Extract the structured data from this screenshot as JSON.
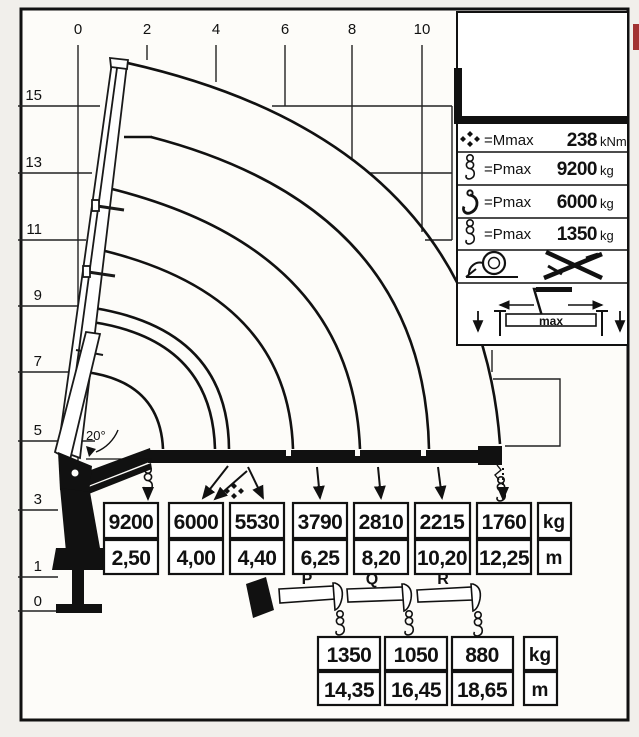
{
  "chart_data": {
    "type": "line",
    "title": "Crane load capacity diagram",
    "x_ticks": [
      0,
      2,
      4,
      6,
      8,
      10
    ],
    "y_ticks": [
      15,
      13,
      11,
      9,
      7,
      5,
      3,
      1,
      0
    ],
    "boom_angle_deg": 20,
    "series": [
      {
        "name": "hydraulic-extensions",
        "loads_kg": [
          9200,
          6000,
          5530,
          3790,
          2810,
          2215,
          1760
        ],
        "outreach_m": [
          2.5,
          4.0,
          4.4,
          6.25,
          8.2,
          10.2,
          12.25
        ]
      },
      {
        "name": "manual-extensions",
        "labels": [
          "P",
          "Q",
          "R"
        ],
        "loads_kg": [
          1350,
          1050,
          880
        ],
        "outreach_m": [
          14.35,
          16.45,
          18.65
        ]
      }
    ],
    "maxima": {
      "Mmax_kNm": 238,
      "Pmax_main_kg": 9200,
      "Pmax_hook_kg": 6000,
      "Pmax_ext_kg": 1350
    },
    "legend_position": "top-right",
    "grid": true
  },
  "axes": {
    "x_ticks": [
      "0",
      "2",
      "4",
      "6",
      "8",
      "10"
    ],
    "y_ticks": [
      "15",
      "13",
      "11",
      "9",
      "7",
      "5",
      "3",
      "1",
      "0"
    ]
  },
  "annotations": {
    "boom_angle": "20°"
  },
  "legend": {
    "rows": [
      {
        "icon": "mmax-symbol",
        "label": "=Mmax",
        "value": "238",
        "unit": "kNm"
      },
      {
        "icon": "hook-with-pulley",
        "label": "=Pmax",
        "value": "9200",
        "unit": "kg"
      },
      {
        "icon": "hook",
        "label": "=Pmax",
        "value": "6000",
        "unit": "kg"
      },
      {
        "icon": "hook-with-pulley-sm",
        "label": "=Pmax",
        "value": "1350",
        "unit": "kg"
      }
    ],
    "extra_icons": [
      "winch",
      "crossed-extensions"
    ],
    "outrigger_max_label": "max"
  },
  "main_table": {
    "loads": [
      "9200",
      "6000",
      "5530",
      "3790",
      "2810",
      "2215",
      "1760"
    ],
    "reaches": [
      "2,50",
      "4,00",
      "4,40",
      "6,25",
      "8,20",
      "10,20",
      "12,25"
    ],
    "unit_load": "kg",
    "unit_reach": "m"
  },
  "extension_table": {
    "labels": [
      "P",
      "Q",
      "R"
    ],
    "loads": [
      "1350",
      "1050",
      "880"
    ],
    "reaches": [
      "14,35",
      "16,45",
      "18,65"
    ],
    "unit_load": "kg",
    "unit_reach": "m"
  }
}
